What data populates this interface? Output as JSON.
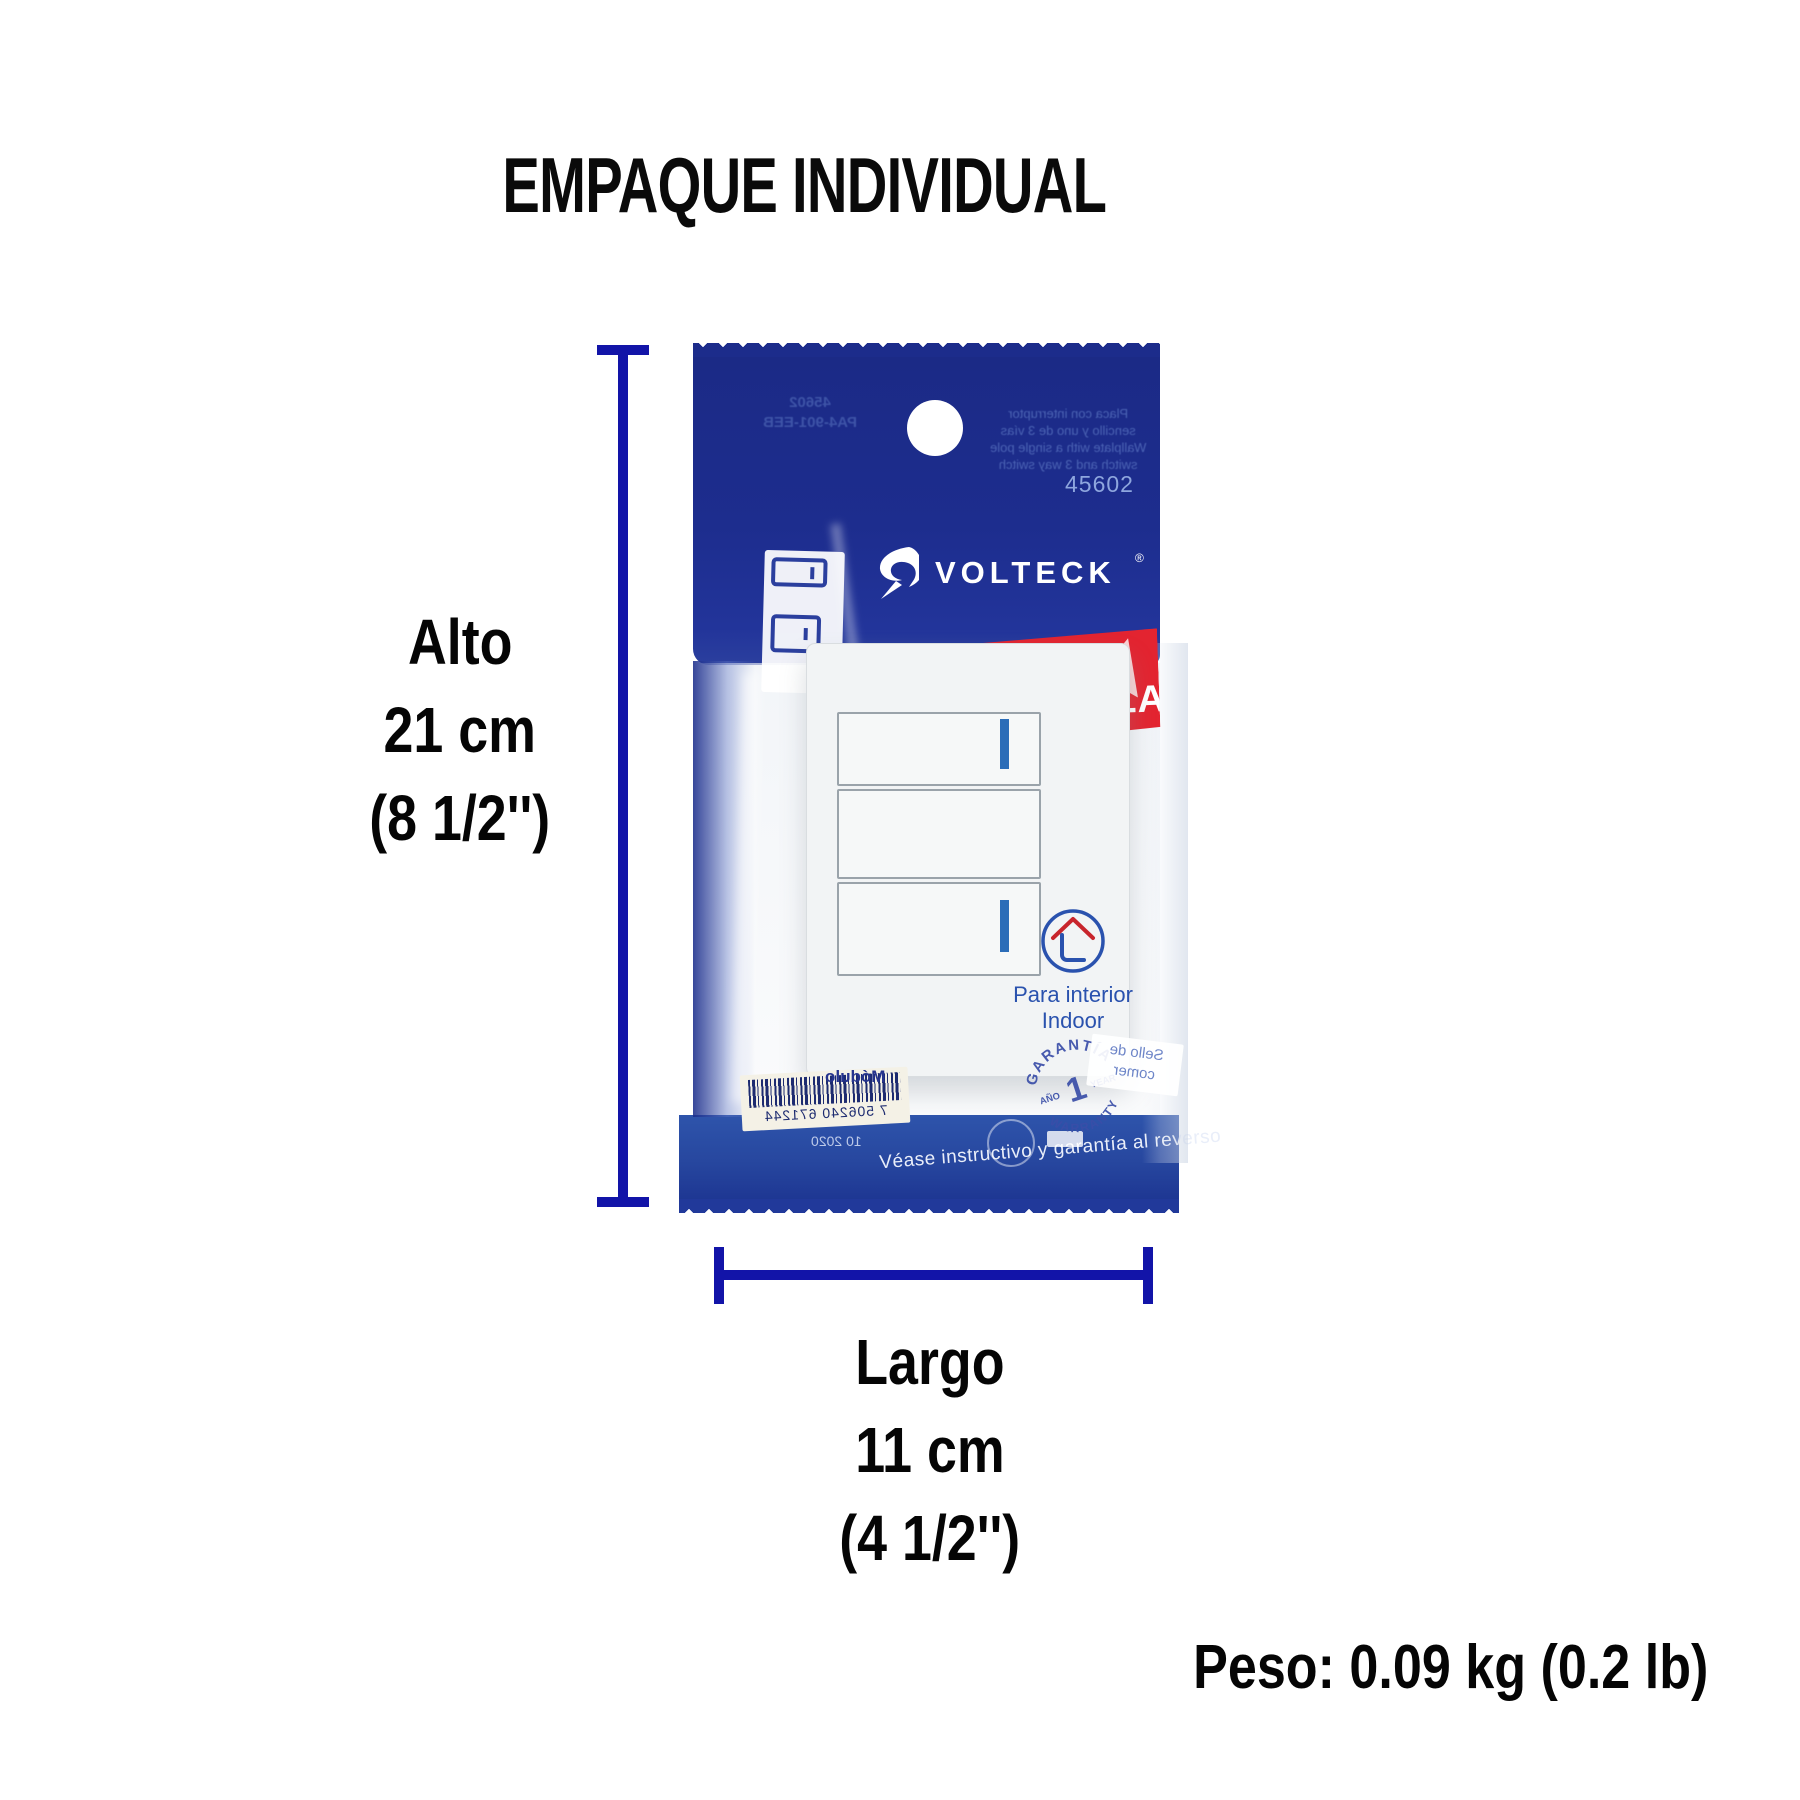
{
  "title": "EMPAQUE INDIVIDUAL",
  "dimensions": {
    "height": {
      "label": "Alto",
      "value": "21 cm",
      "inches": "(8 1/2'')"
    },
    "length": {
      "label": "Largo",
      "value": "11 cm",
      "inches": "(4 1/2'')"
    },
    "weight_label": "Peso:",
    "weight_value": " 0.09 kg (0.2 lb)"
  },
  "bag": {
    "sku": "45602",
    "brand": "VOLTECK",
    "brand_reg": "®",
    "banner_line1": "Línea",
    "banner_line2": "ESPAÑOLA",
    "back_print_mirrored": {
      "code_line1": "45602",
      "code_line2": "PA4-901-EEB",
      "desc_lines": [
        "Placa con interruptor",
        "sencillo y uno de 3 vías",
        "Wallplate with a single pole",
        "switch and 3 way switch"
      ]
    },
    "indoor_line1": "Para interior",
    "indoor_line2": "Indoor",
    "warranty": {
      "arc_top": "GARANTÍA",
      "left": "AÑO",
      "number": "1",
      "right": "YEAR",
      "arc_bottom": "WARRANTY"
    },
    "barcode": {
      "caption": "Módulo",
      "digits": "7 506240 671244",
      "date": "10 2020"
    },
    "seal_line1": "Sello de",
    "seal_line2": "comer",
    "bottom_note": "Véase instructivo y garantía al reverso"
  },
  "colors": {
    "bag_navy": "#1d2d8d",
    "bag_band_blue": "#2a4ba5",
    "banner_red": "#e32430",
    "dimension_blue": "#1214a8",
    "brand_blue": "#2b3f9e",
    "indicator_blue": "#2b6db8",
    "indoor_blue": "#2a52ae",
    "roof_red": "#c8252c"
  }
}
